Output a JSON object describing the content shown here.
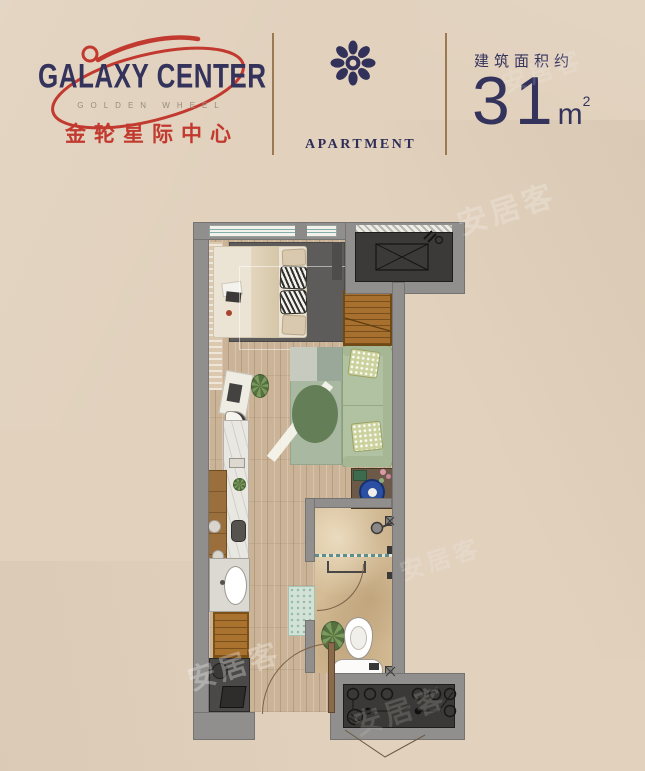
{
  "page": {
    "background": "#e1d1bd",
    "watermark": "安居客"
  },
  "header": {
    "logo": {
      "title": "GALAXY CENTER",
      "subtitle": "GOLDEN WHEEL",
      "chinese_name": "金轮星际中心"
    },
    "apartment": {
      "label": "APARTMENT"
    },
    "area": {
      "label": "建筑面积约",
      "value": "31",
      "unit": "m",
      "unit_sup": "2"
    },
    "colors": {
      "navy": "#34335c",
      "red": "#c23a2f",
      "divider_brown": "#9b7a52",
      "subtitle_gray": "#958d7e"
    }
  },
  "floorplan": {
    "type": "studio-apartment-floor-plan",
    "area_sqm": 31,
    "rooms": [
      "bedroom",
      "living-area",
      "kitchen-strip",
      "bathroom",
      "ac-platform",
      "entry"
    ],
    "colors": {
      "wall": "#908f8d",
      "wood_floor": "#cab397",
      "marble_floor": "#d4bc96",
      "dark_rug": "#5d5c5a",
      "sofa_green": "#b1c2a2",
      "rug_green": "#a9b8a0",
      "wardrobe_wood": "#a8702e",
      "bowl_blue": "#2b4fa3",
      "platform_dark": "#3c3a38",
      "window_teal": "#7fb0ad"
    }
  }
}
